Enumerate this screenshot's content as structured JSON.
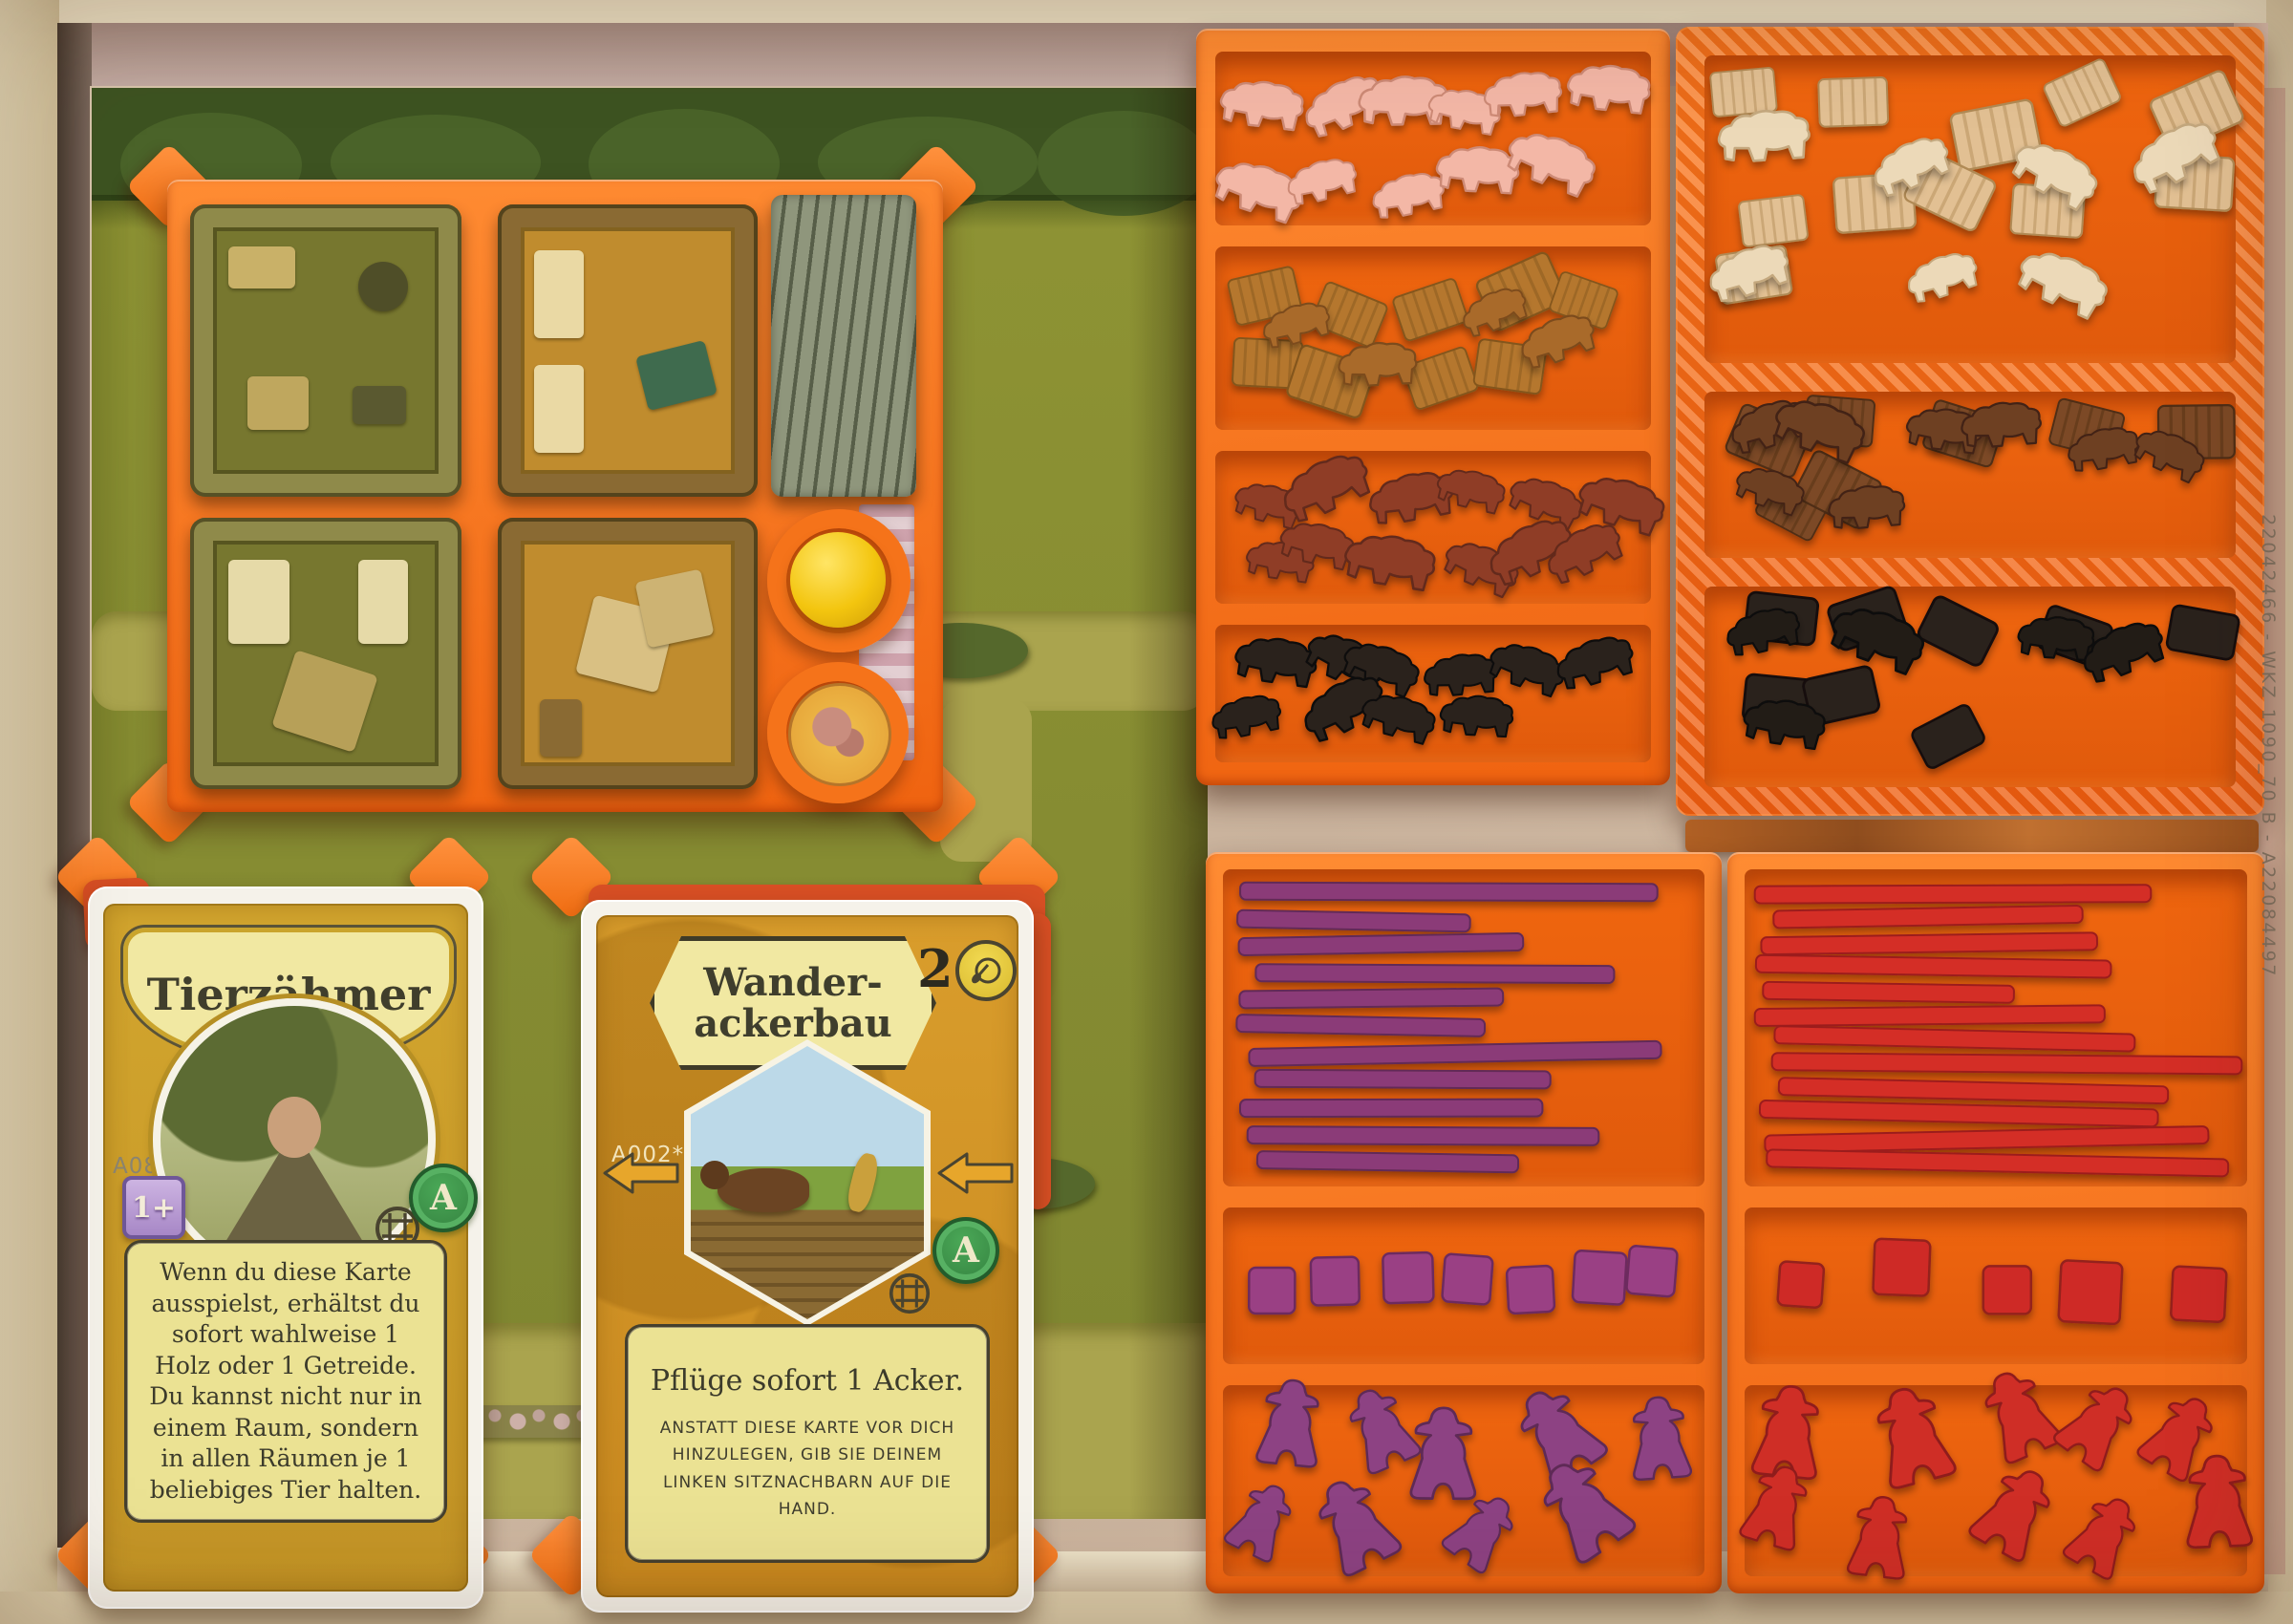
{
  "edge_code": "22042466 - WKZ 1090_70 B - A22084497",
  "cards": {
    "tierzaehmer": {
      "title": "Tierzähmer",
      "code": "A086*",
      "players_badge": "1+",
      "deck_letter": "A",
      "body": "Wenn du diese Karte ausspielst, erhältst du sofort wahlweise 1 Holz oder 1 Getreide. Du kannst nicht nur in einem Raum, sondern in allen Räumen je 1 beliebiges Tier halten."
    },
    "wanderackerbau": {
      "title_line1": "Wander-",
      "title_line2": "ackerbau",
      "cost": "2",
      "code": "A002*",
      "deck_letter": "A",
      "body_main": "Pflüge sofort 1 Acker.",
      "body_small": "ANSTATT DIESE KARTE VOR DICH HINZULEGEN, GIB SIE DEINEM LINKEN SITZNACHBARN AUF DIE HAND."
    }
  },
  "palette": {
    "box_rim": "#d9c9a6",
    "box_rim_light": "#e8dcc0",
    "wall_left": "#5e4c40",
    "board_green": "#8f9434",
    "forest": "#3d5321",
    "path_khaki": "#aaa44e",
    "orange": "#f87b1d",
    "orange_floor": "#ee6a12",
    "tile_olive": "#77772f",
    "tile_tan": "#c08c2e",
    "card_gold": "#cfa22b",
    "card_pale": "#f1e8a2",
    "card_amber": "#d6982a",
    "deck_red": "#d84f24",
    "sleeve": "#f5f2ea",
    "code_text": "#7b6f5f",
    "ball_yellow": "#f3c50f",
    "tile_stack_gray": "#8f967c",
    "sheep_pink": "#f3b7a6",
    "wood_caramel": "#b5772f",
    "boar_russet": "#8f3d26",
    "cattle_black": "#29201b",
    "bundle_tan": "#e2c093",
    "bundle_brown": "#7c4a26",
    "piece_purple": "#8b3b78",
    "piece_red": "#d42f28"
  },
  "pieces": [
    {
      "name": "sheep-meeples-pink",
      "shape": "animal",
      "color": "#f3b7a6",
      "dark": "#cd8a76",
      "count": 11,
      "area": [
        1284,
        72,
        432,
        152
      ],
      "seed": 11,
      "scale": 0.92
    },
    {
      "name": "wood-blocks-caramel",
      "shape": "ribbed",
      "color": "#b5772f",
      "dark": "#84561e",
      "count": 9,
      "area": [
        1284,
        272,
        432,
        160
      ],
      "seed": 21,
      "scale": 1.0
    },
    {
      "name": "boar-meeples-caramel",
      "shape": "animal",
      "color": "#a96a2c",
      "dark": "#7c4b1d",
      "count": 4,
      "area": [
        1300,
        300,
        400,
        116
      ],
      "seed": 22,
      "scale": 0.85
    },
    {
      "name": "boar-meeples-russet",
      "shape": "animal",
      "color": "#8f3d26",
      "dark": "#63291a",
      "count": 12,
      "area": [
        1284,
        484,
        432,
        132
      ],
      "seed": 31,
      "scale": 0.9
    },
    {
      "name": "cattle-meeples-black",
      "shape": "animal",
      "color": "#29201b",
      "dark": "#110d0b",
      "count": 10,
      "area": [
        1284,
        664,
        432,
        118
      ],
      "seed": 41,
      "scale": 0.92
    },
    {
      "name": "grain-bundles-tan",
      "shape": "ribbed",
      "color": "#e2c093",
      "dark": "#b08a55",
      "count": 11,
      "area": [
        1794,
        72,
        536,
        276
      ],
      "seed": 51,
      "scale": 1.05
    },
    {
      "name": "sheep-meeples-cream",
      "shape": "animal",
      "color": "#ecd9b8",
      "dark": "#c4a87e",
      "count": 7,
      "area": [
        1804,
        120,
        516,
        216
      ],
      "seed": 52,
      "scale": 0.95
    },
    {
      "name": "wood-bundles-brown",
      "shape": "ribbed",
      "color": "#7c4a26",
      "dark": "#4f2d15",
      "count": 7,
      "area": [
        1794,
        416,
        536,
        148
      ],
      "seed": 61,
      "scale": 1.0
    },
    {
      "name": "boar-meeples-brown",
      "shape": "animal",
      "color": "#6e3f22",
      "dark": "#432413",
      "count": 8,
      "area": [
        1794,
        424,
        536,
        140
      ],
      "seed": 62,
      "scale": 0.9
    },
    {
      "name": "peat-blocks-black",
      "shape": "block",
      "color": "#2b211b",
      "dark": "#120d0a",
      "count": 8,
      "area": [
        1794,
        620,
        536,
        176
      ],
      "seed": 71,
      "scale": 1.05
    },
    {
      "name": "cattle-meeples-dark",
      "shape": "animal",
      "color": "#241b16",
      "dark": "#0d0a08",
      "count": 5,
      "area": [
        1804,
        640,
        516,
        146
      ],
      "seed": 72,
      "scale": 0.95
    },
    {
      "name": "fence-sticks-purple",
      "shape": "stick",
      "color": "#8b3b78",
      "dark": "#622a56",
      "count": 11,
      "area": [
        1290,
        920,
        484,
        310
      ],
      "seed": 81
    },
    {
      "name": "cubes-purple",
      "shape": "cube",
      "color": "#9a4184",
      "dark": "#6d2c5e",
      "count": 7,
      "area": [
        1290,
        1276,
        484,
        130
      ],
      "seed": 82,
      "sizes": [
        48,
        50,
        52,
        50,
        48,
        54,
        50
      ]
    },
    {
      "name": "farmer-meeples-purple",
      "shape": "farmer",
      "color": "#8d4383",
      "dark": "#5e2b57",
      "count": 9,
      "area": [
        1290,
        1456,
        484,
        180
      ],
      "seed": 83,
      "scale": 1.0
    },
    {
      "name": "fence-sticks-red",
      "shape": "stick",
      "color": "#d42f28",
      "dark": "#9c1f1b",
      "count": 12,
      "area": [
        1836,
        920,
        506,
        310
      ],
      "seed": 91
    },
    {
      "name": "cubes-red",
      "shape": "cube",
      "color": "#ce2b26",
      "dark": "#94201c",
      "count": 5,
      "area": [
        1836,
        1276,
        506,
        130
      ],
      "seed": 92,
      "sizes": [
        46,
        58,
        50,
        64,
        56
      ]
    },
    {
      "name": "farmer-meeples-red",
      "shape": "farmer",
      "color": "#cf2d28",
      "dark": "#8f1e1a",
      "count": 10,
      "area": [
        1836,
        1456,
        506,
        180
      ],
      "seed": 93,
      "scale": 1.0
    }
  ]
}
